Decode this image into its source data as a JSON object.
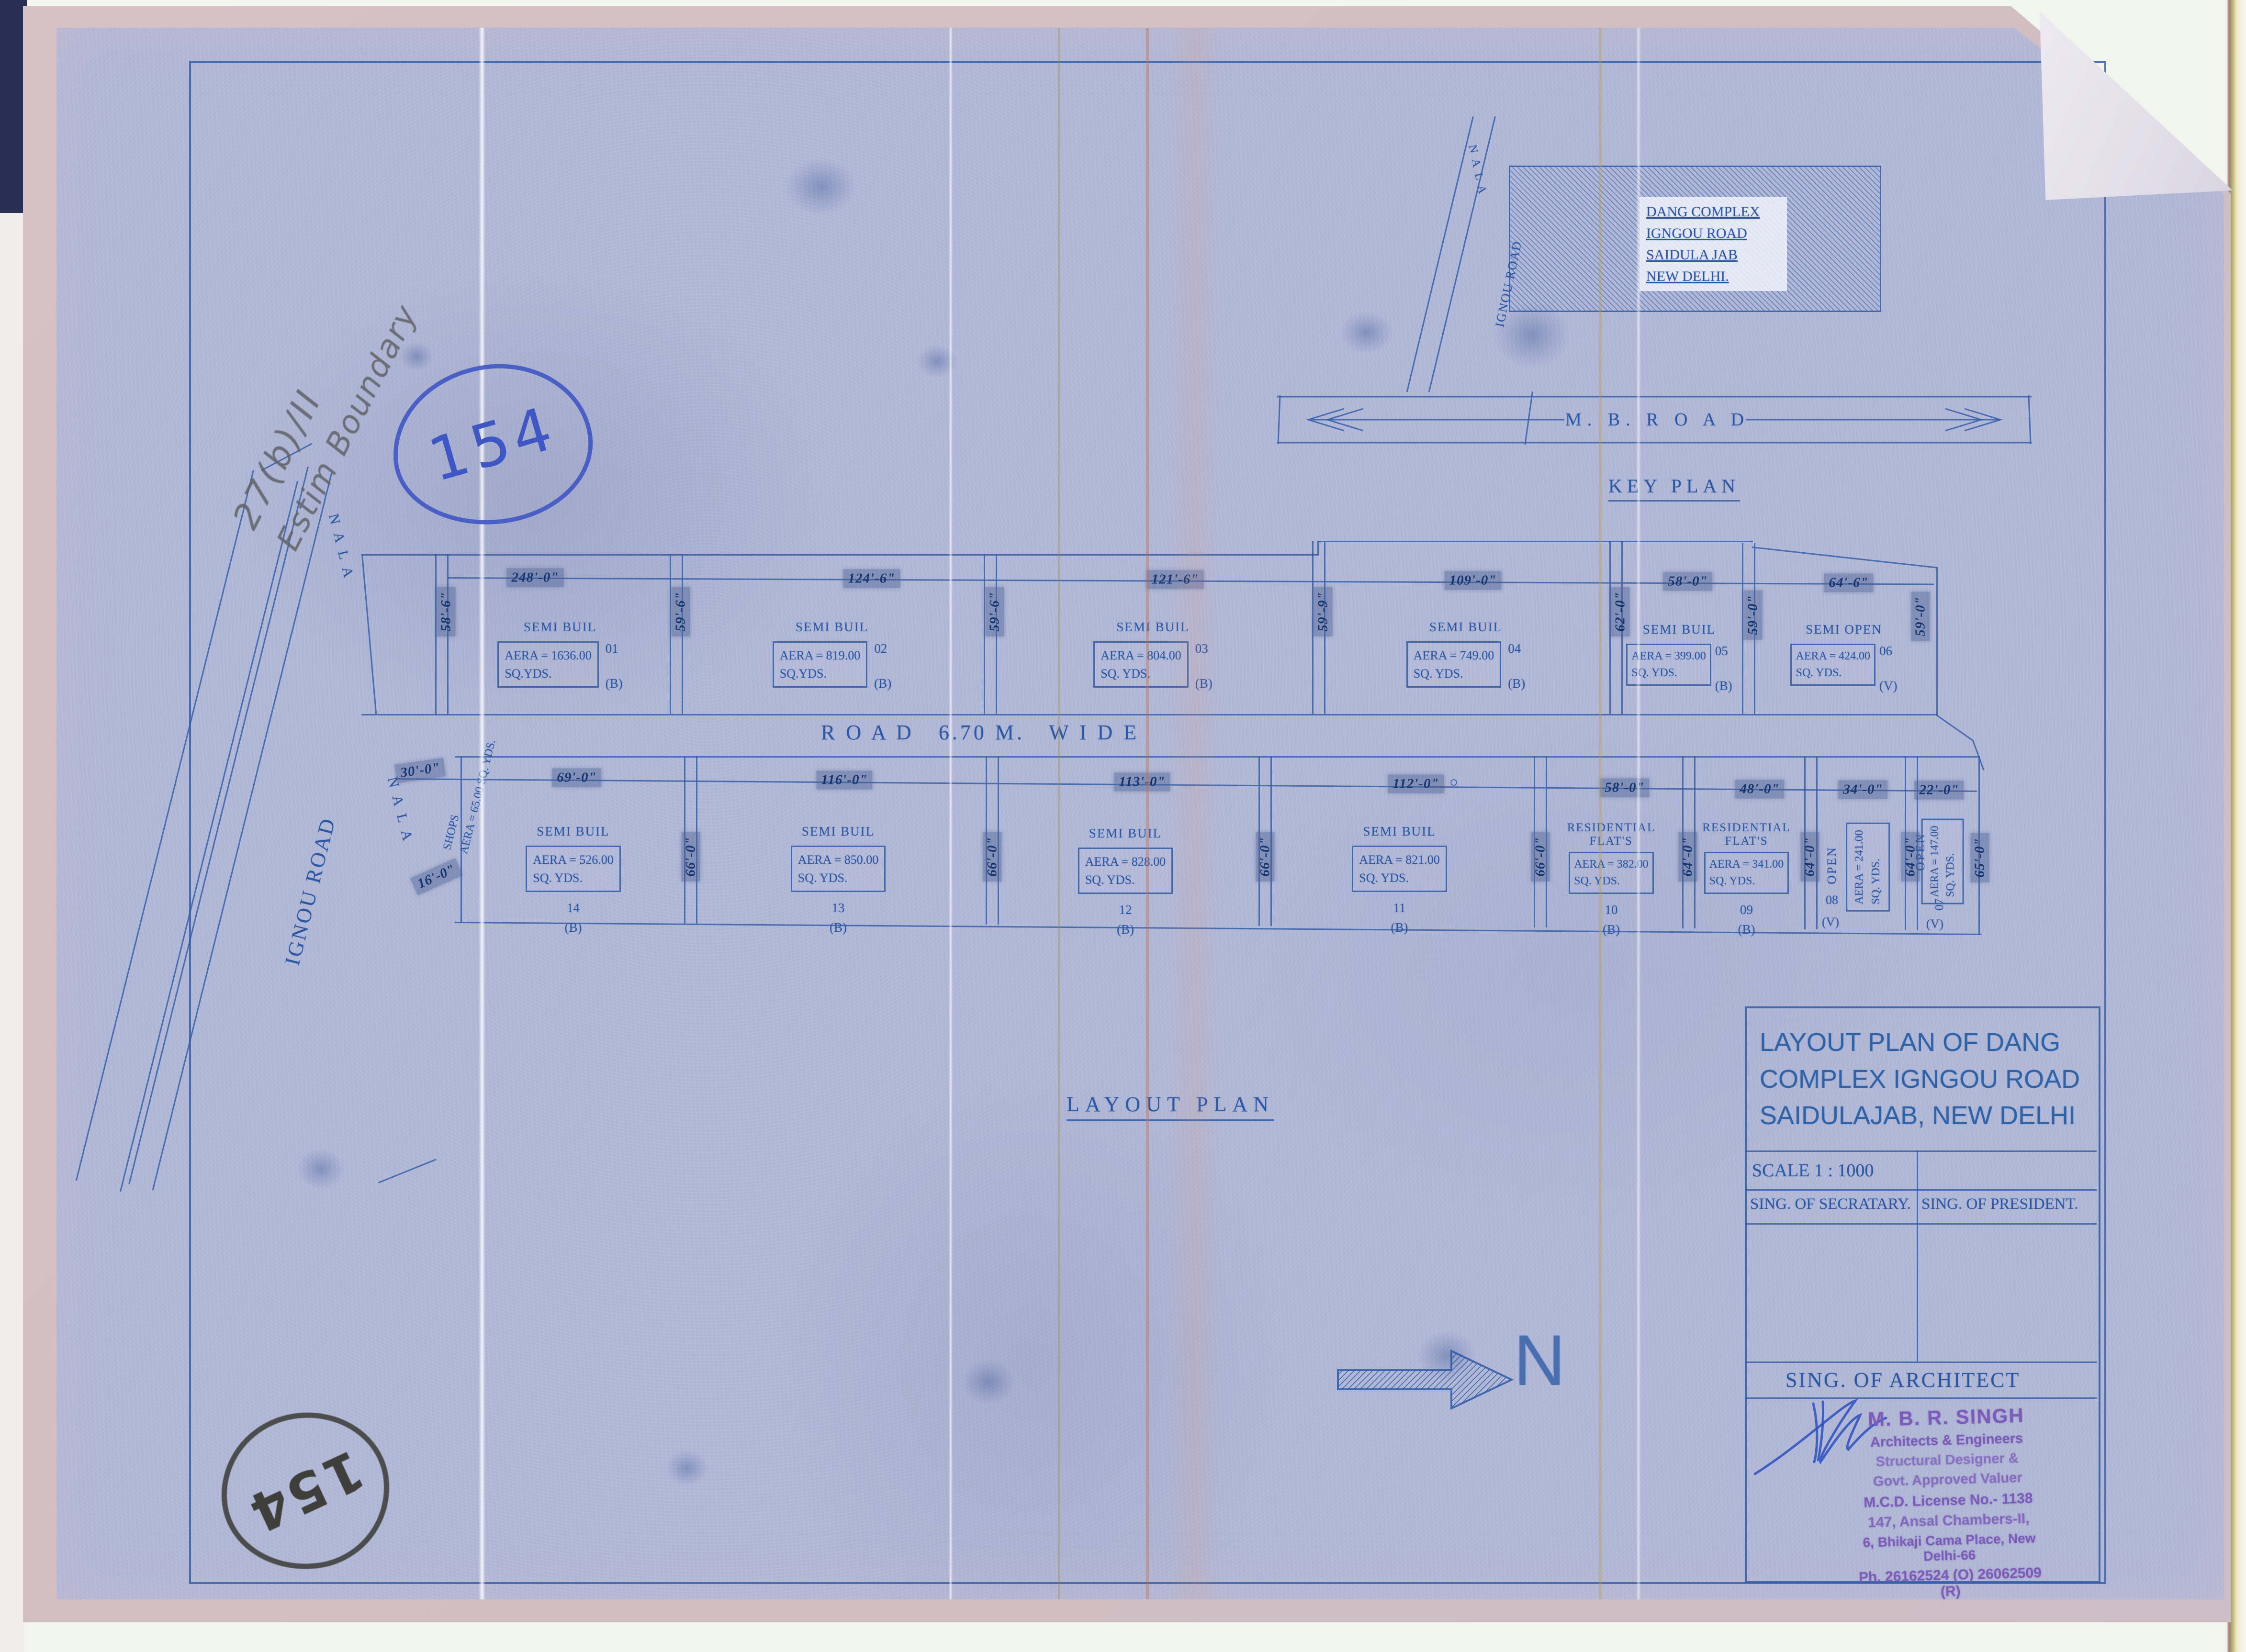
{
  "colors": {
    "ink": "#2b57a3",
    "line": "#3a63ab",
    "stamp_purple": "#7b5cb8",
    "pen_blue": "#3f57c4",
    "pencil_grey": "#6f7276",
    "paper_blue": "#aeb5d5"
  },
  "annotations": {
    "circled_number_top": "154",
    "circled_number_bottom": "154",
    "pencil_note_line1": "27(b)/II",
    "pencil_note_line2": "Estim Boundary"
  },
  "key_plan": {
    "heading": "KEY PLAN",
    "mb_road_label": "M. B. R O A D",
    "nala_label": "N A L A",
    "road_name": "IGNOU ROAD",
    "block_lines": [
      "DANG COMPLEX",
      "IGNGOU ROAD",
      "SAIDULA JAB",
      "NEW DELHI."
    ]
  },
  "layout": {
    "heading": "LAYOUT PLAN",
    "road_label": "R O A D   6.70 M.   W I D E",
    "ignou_road": "IGNOU ROAD",
    "nala_upper": "N A L A",
    "nala_lower": "N A L A",
    "shops": {
      "name": "SHOPS",
      "area": "AERA = 65.00 SQ. YDS.",
      "width": "30'-0\"",
      "depth": "16'-0\""
    },
    "top_row": {
      "left_depth": "58'-6\"",
      "plots": [
        {
          "no": "01",
          "type": "SEMI BUIL",
          "area": "AERA = 1636.00",
          "units": "SQ.YDS.",
          "cls": "(B)",
          "width": "248'-0\"",
          "depth": "59'-6\""
        },
        {
          "no": "02",
          "type": "SEMI BUIL",
          "area": "AERA = 819.00",
          "units": "SQ.YDS.",
          "cls": "(B)",
          "width": "124'-6\"",
          "depth": "59'-6\""
        },
        {
          "no": "03",
          "type": "SEMI BUIL",
          "area": "AERA = 804.00",
          "units": "SQ. YDS.",
          "cls": "(B)",
          "width": "121'-6\"",
          "depth": "59'-9\""
        },
        {
          "no": "04",
          "type": "SEMI BUIL",
          "area": "AERA = 749.00",
          "units": "SQ. YDS.",
          "cls": "(B)",
          "width": "109'-0\"",
          "depth": "62'-0\""
        },
        {
          "no": "05",
          "type": "SEMI BUIL",
          "area": "AERA = 399.00",
          "units": "SQ. YDS.",
          "cls": "(B)",
          "width": "58'-0\"",
          "depth": "59'-0\""
        },
        {
          "no": "06",
          "type": "SEMI OPEN",
          "area": "AERA = 424.00",
          "units": "SQ. YDS.",
          "cls": "(V)",
          "width": "64'-6\"",
          "depth": "59'-0\""
        }
      ]
    },
    "bottom_row": {
      "right_depth": "65'-0\"",
      "plots": [
        {
          "no": "14",
          "type": "SEMI BUIL",
          "area": "AERA = 526.00",
          "units": "SQ. YDS.",
          "cls": "(B)",
          "width": "69'-0\"",
          "depth": "66'-0\""
        },
        {
          "no": "13",
          "type": "SEMI BUIL",
          "area": "AERA = 850.00",
          "units": "SQ. YDS.",
          "cls": "(B)",
          "width": "116'-0\"",
          "depth": "66'-0\""
        },
        {
          "no": "12",
          "type": "SEMI BUIL",
          "area": "AERA = 828.00",
          "units": "SQ. YDS.",
          "cls": "(B)",
          "width": "113'-0\"",
          "depth": "66'-0\""
        },
        {
          "no": "11",
          "type": "SEMI BUIL",
          "area": "AERA = 821.00",
          "units": "SQ. YDS.",
          "cls": "(B)",
          "width": "112'-0\"",
          "depth": "66'-0\""
        },
        {
          "no": "10",
          "type": "RESIDENTIAL FLAT'S",
          "area": "AERA = 382.00",
          "units": "SQ. YDS.",
          "cls": "(B)",
          "width": "58'-0\"",
          "depth": "64'-0\""
        },
        {
          "no": "09",
          "type": "RESIDENTIAL FLAT'S",
          "area": "AERA = 341.00",
          "units": "SQ. YDS.",
          "cls": "(B)",
          "width": "48'-0\"",
          "depth": "64'-0\""
        },
        {
          "no": "08",
          "type": "OPEN",
          "area": "AERA = 241.00",
          "units": "SQ. YDS.",
          "cls": "(V)",
          "width": "34'-0\"",
          "depth": "64'-0\""
        },
        {
          "no": "07",
          "type": "OPEN",
          "area": "AERA = 147.00",
          "units": "SQ. YDS.",
          "cls": "(V)",
          "width": "22'-0\""
        }
      ]
    }
  },
  "north": {
    "label": "N"
  },
  "title_block": {
    "title_lines": [
      "LAYOUT PLAN OF DANG",
      "COMPLEX IGNGOU ROAD",
      "SAIDULAJAB, NEW DELHI"
    ],
    "scale": "SCALE 1 : 1000",
    "sign_secretary": "SING. OF SECRATARY.",
    "sign_president": "SING. OF PRESIDENT.",
    "sign_architect": "SING. OF ARCHITECT",
    "stamp_lines": [
      "M. B. R. SINGH",
      "Architects & Engineers",
      "Structural Designer &",
      "Govt. Approved Valuer",
      "M.C.D. License No.- 1138",
      "147, Ansal Chambers-II,",
      "6, Bhikaji Cama Place, New Delhi-66",
      "Ph. 26162524 (O) 26062509 (R)"
    ]
  }
}
